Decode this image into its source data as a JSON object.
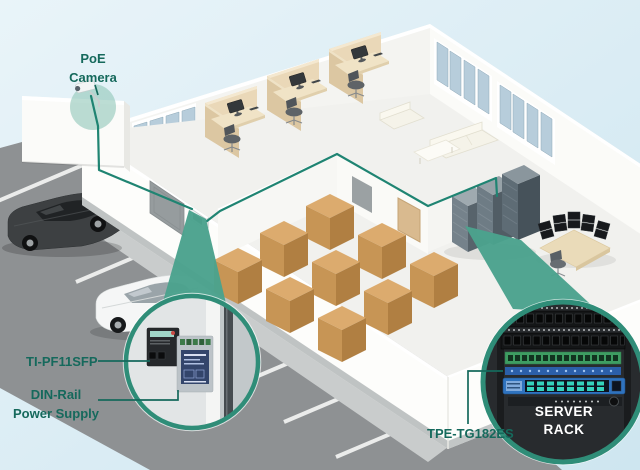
{
  "diagram": {
    "description": "Isometric cutaway office-warehouse building with PoE surveillance install, parking lot, and two circular equipment callouts"
  },
  "labels": {
    "poe_camera": "PoE Camera",
    "ti_pf11sfp": "TI-PF11SFP",
    "din_rail_power_supply": "DIN-Rail Power Supply",
    "tpe_tg182es": "TPE-TG182ES",
    "server_rack": "SERVER RACK"
  },
  "colors": {
    "accent_teal_cable": "#1F8472",
    "label_text": "#15695C",
    "callout_wedge": "#4BA28D",
    "callout_ring": "#2F8D78",
    "background_sky": "#D9ECF4",
    "asphalt": "#8E9193",
    "box_tan": "#DCAB6E",
    "switch_blue": "#2F73BF",
    "patch_panel_green": "#3E9D62",
    "rack_inset_dark": "#282B2E"
  },
  "icons": {
    "camera": "poe-camera-icon",
    "cable": "network-cable-line",
    "din_callout": "din-rail-callout-circle",
    "rack_callout": "server-rack-callout-circle"
  }
}
